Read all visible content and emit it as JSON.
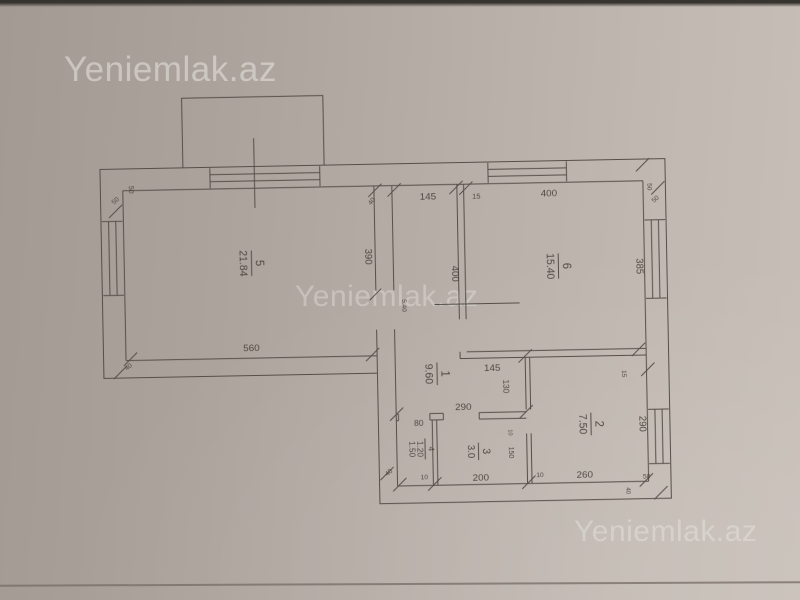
{
  "watermarks": {
    "top_left": "Yeniemlak.az",
    "center": "Yeniemlak.az",
    "bottom_right": "Yeniemlak.az"
  },
  "floor_plan": {
    "rooms": [
      {
        "number": "5",
        "area": "21.84"
      },
      {
        "number": "6",
        "area": "15.40"
      },
      {
        "number": "1",
        "area": "9.60"
      },
      {
        "number": "2",
        "area": "7.50"
      },
      {
        "number": "3",
        "area": "3.0"
      },
      {
        "number": "4",
        "area": "1.20",
        "area_extra": "1.50"
      }
    ],
    "dims": {
      "room5_width": "560",
      "room5_height": "390",
      "room5_door": "5.40",
      "hall_top": "145",
      "hall_side": "400",
      "hall_bottom": "145",
      "hall_lower": "290",
      "hall_wall": "130",
      "top_wall_15": "15",
      "room6_top": "400",
      "room6_side": "385",
      "right_wall_15": "15",
      "room2_side": "290",
      "room2_bottom": "260",
      "room3_bottom": "200",
      "room3_side": "150",
      "room4_top": "80",
      "t10_a": "10",
      "t10_b": "10",
      "t10_c": "10",
      "t50_tl_a": "50",
      "t50_tl_b": "50",
      "t50_tr_a": "50",
      "t50_tr_b": "50",
      "t50_br": "50",
      "t40_hall": "40",
      "t40_bl": "40",
      "t40_bls": "40",
      "t40_br": "40"
    }
  },
  "colors": {
    "paper_left": "#a39a93",
    "paper_right": "#c7bfb7",
    "line": "#554f49",
    "text": "#403a34",
    "watermark": "#eceae6"
  }
}
